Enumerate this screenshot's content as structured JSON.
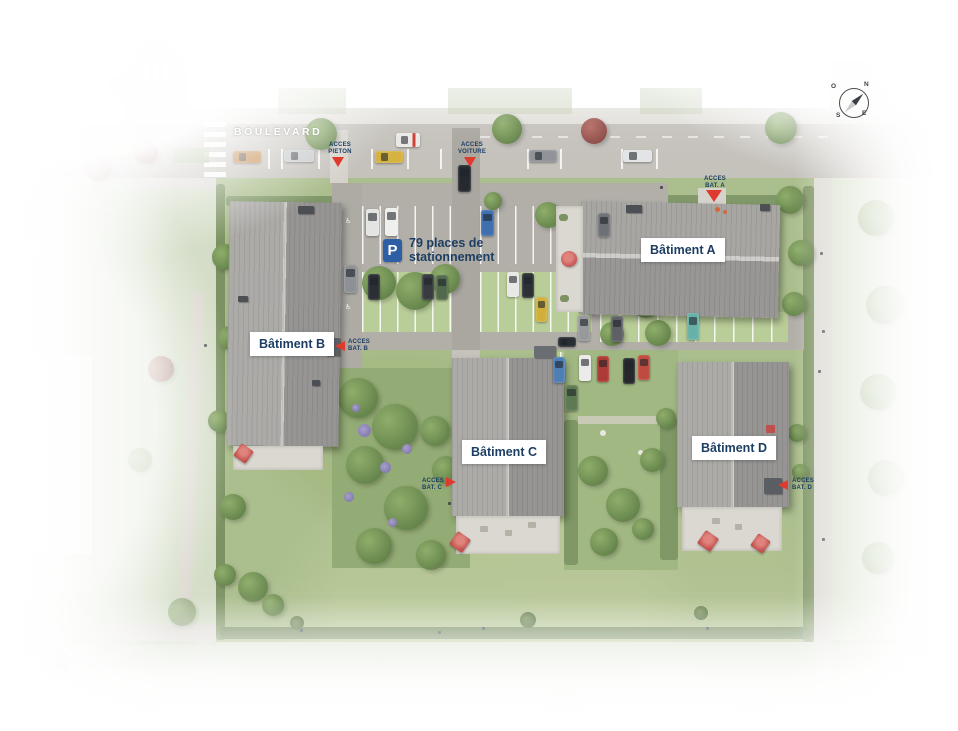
{
  "street": {
    "name": "BOULEVARD"
  },
  "buildings": [
    {
      "id": "A",
      "label": "Bâtiment A"
    },
    {
      "id": "B",
      "label": "Bâtiment B"
    },
    {
      "id": "C",
      "label": "Bâtiment C"
    },
    {
      "id": "D",
      "label": "Bâtiment D"
    }
  ],
  "access_points": [
    {
      "id": "pieton",
      "label": "ACCES\nPIETON",
      "direction": "down"
    },
    {
      "id": "voiture",
      "label": "ACCES\nVOITURE",
      "direction": "down"
    },
    {
      "id": "bat-a",
      "label": "ACCES\nBAT. A",
      "direction": "down"
    },
    {
      "id": "bat-b",
      "label": "ACCES\nBAT. B",
      "direction": "left"
    },
    {
      "id": "bat-c",
      "label": "ACCES\nBAT. C",
      "direction": "right"
    },
    {
      "id": "bat-d",
      "label": "ACCES\nBAT. D",
      "direction": "left"
    }
  ],
  "parking": {
    "sign_letter": "P",
    "label": "79 places de\nstationnement",
    "handicap_icon": "♿"
  },
  "compass": {
    "n": "N",
    "s": "S",
    "e": "E",
    "o": "O"
  },
  "colors": {
    "accent_red": "#e03a2e",
    "label_navy": "#1d3e63",
    "parking_blue": "#2e5fa4",
    "roof_gray": "#9e9c99",
    "lawn_green": "#abbe8d"
  }
}
